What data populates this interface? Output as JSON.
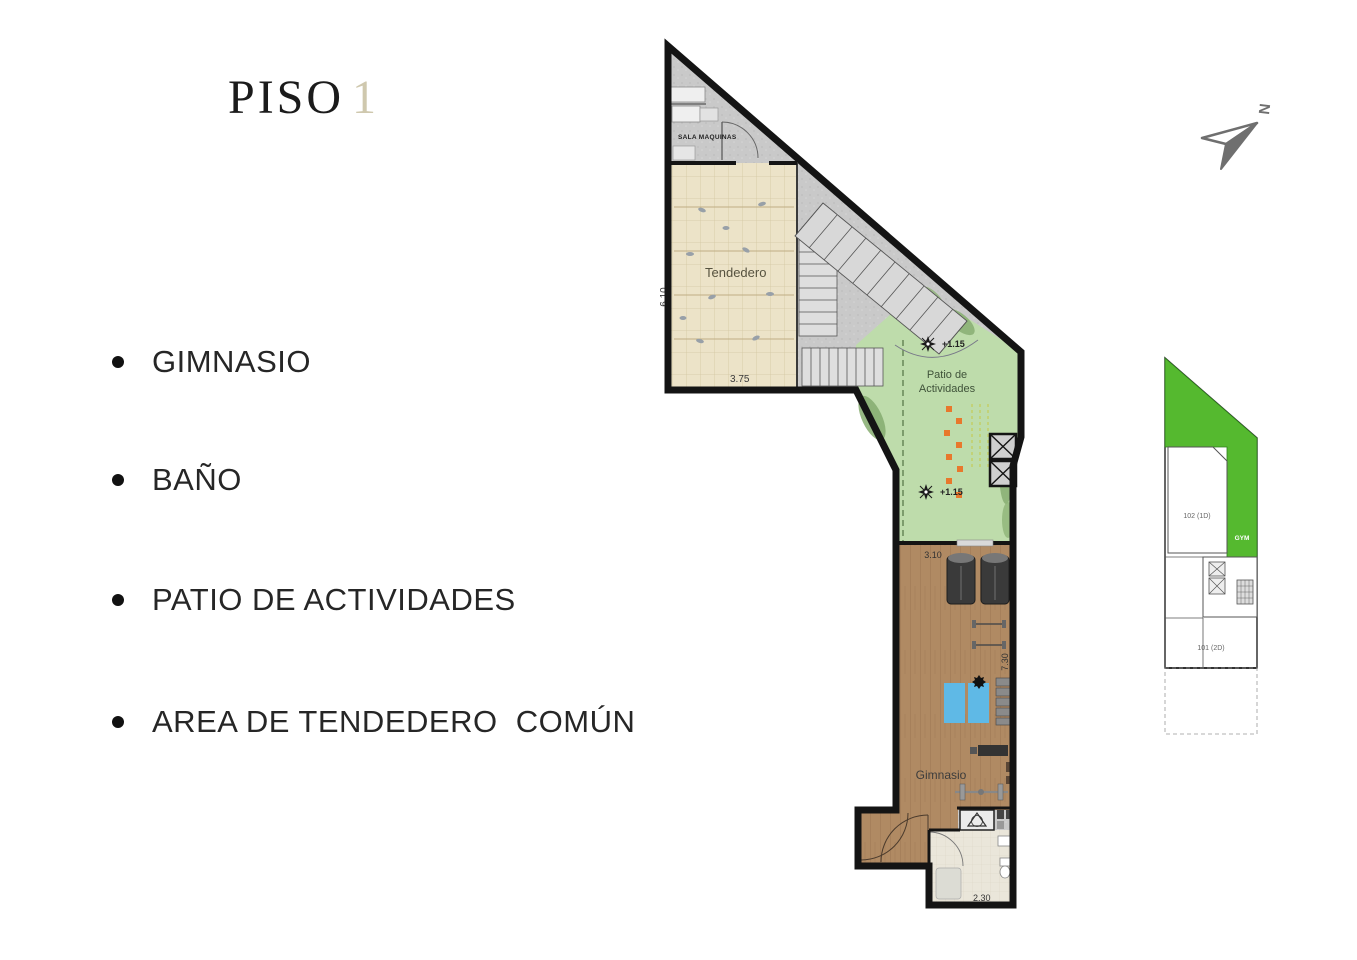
{
  "title": {
    "word": "PISO",
    "number": "1"
  },
  "bullets": [
    {
      "label": "GIMNASIO"
    },
    {
      "label": "BAÑO"
    },
    {
      "label": "PATIO DE ACTIVIDADES"
    },
    {
      "label": "AREA DE TENDEDERO  COMÚN"
    }
  ],
  "plan": {
    "labels": {
      "sala_maquinas": "SALA MAQUINAS",
      "tendedero": "Tendedero",
      "patio_line1": "Patio de",
      "patio_line2": "Actividades",
      "gimnasio": "Gimnasio"
    },
    "dims": {
      "d610": "6.10",
      "d375": "3.75",
      "d310": "3.10",
      "d730": "7.30",
      "d230": "2.30"
    },
    "levels": {
      "m1": "+1.15",
      "m2": "+1.15"
    }
  },
  "keyplan": {
    "unit_top": "102 (1D)",
    "gym": "GYM",
    "unit_bottom": "101 (2D)"
  },
  "north": {
    "label": "N"
  },
  "colors": {
    "title_number": "#cfc8ae",
    "concrete": "#c9c9c9",
    "tile_beige": "#ece3c8",
    "patio_green": "#bedcab",
    "wood_brown": "#b08a63",
    "bath_beige": "#eae6da",
    "keyplan_green": "#55b92f",
    "orange_accent": "#e8782c",
    "mat_blue": "#5fb9e6",
    "north_gray": "#6f6f6f",
    "outline": "#141414"
  }
}
